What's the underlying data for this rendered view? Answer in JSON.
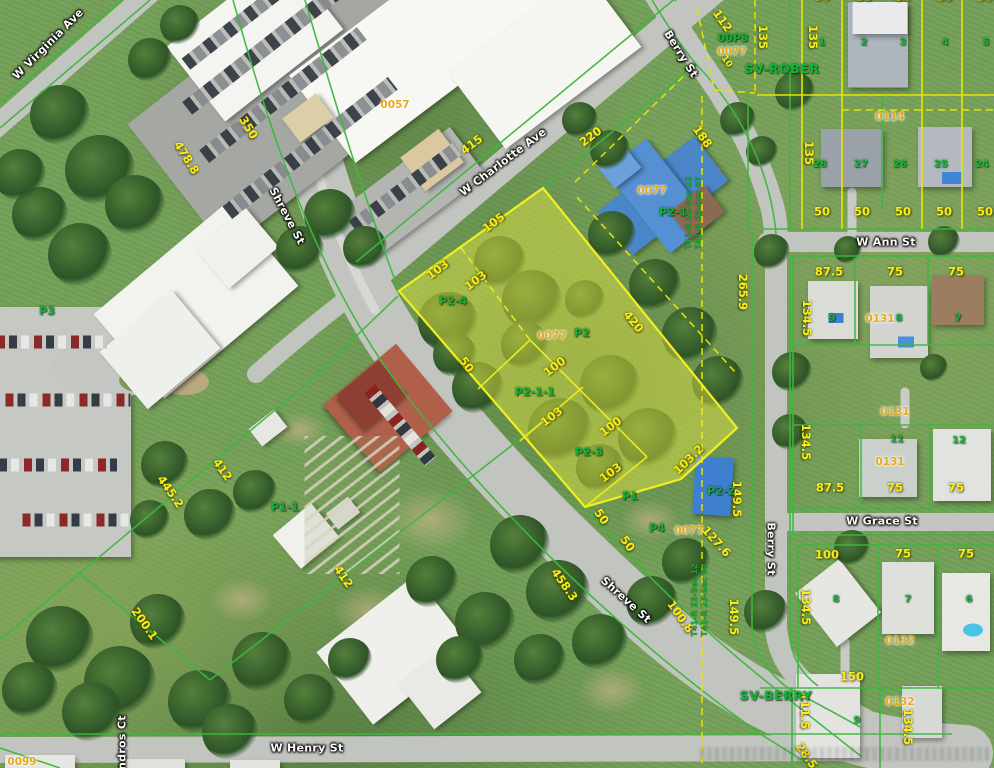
{
  "map": {
    "description": "Aerial parcel map with highlighted subject parcels",
    "colors": {
      "highlight_fill": "rgba(247,242,66,0.42)",
      "highlight_stroke": "#f2ef20",
      "parcel_line_green": "#3db83f",
      "parcel_line_yellow": "#e6e600",
      "dimension_text": "#f8ef14",
      "parcel_id_text": "#12b03a",
      "plat_code_text": "#e8a81e",
      "street_text": "#fbfbf9"
    }
  },
  "labels": {
    "streets": [
      {
        "t": "W Virginia Ave",
        "x": 48,
        "y": 44,
        "r": -45
      },
      {
        "t": "Shreve St",
        "x": 287,
        "y": 216,
        "r": 62
      },
      {
        "t": "W Charlotte Ave",
        "x": 503,
        "y": 162,
        "r": -37
      },
      {
        "t": "Berry St",
        "x": 681,
        "y": 54,
        "r": 58
      },
      {
        "t": "W Ann St",
        "x": 886,
        "y": 242,
        "r": 0
      },
      {
        "t": "W Grace St",
        "x": 882,
        "y": 521,
        "r": 0
      },
      {
        "t": "Berry St",
        "x": 771,
        "y": 549,
        "r": 90
      },
      {
        "t": "Shreve St",
        "x": 626,
        "y": 600,
        "r": 42
      },
      {
        "t": "W Henry St",
        "x": 307,
        "y": 748,
        "r": 0
      },
      {
        "t": "Andros Ct",
        "x": 122,
        "y": 747,
        "r": -90
      }
    ],
    "dimensions": [
      {
        "t": "350",
        "x": 248,
        "y": 128,
        "r": 58
      },
      {
        "t": "478.8",
        "x": 186,
        "y": 158,
        "r": 58
      },
      {
        "t": "415",
        "x": 472,
        "y": 145,
        "r": -37
      },
      {
        "t": "220",
        "x": 591,
        "y": 137,
        "r": -37
      },
      {
        "t": "112",
        "x": 722,
        "y": 21,
        "r": 55
      },
      {
        "t": "10",
        "x": 726,
        "y": 62,
        "r": 55,
        "s": 9
      },
      {
        "t": "135",
        "x": 762,
        "y": 37,
        "r": 90
      },
      {
        "t": "135",
        "x": 812,
        "y": 37,
        "r": 90
      },
      {
        "t": "135",
        "x": 808,
        "y": 153,
        "r": 90
      },
      {
        "t": "188",
        "x": 702,
        "y": 137,
        "r": 55
      },
      {
        "t": "50",
        "x": 822,
        "y": -3,
        "r": 0
      },
      {
        "t": "50",
        "x": 864,
        "y": -3,
        "r": 0
      },
      {
        "t": "50",
        "x": 903,
        "y": -3,
        "r": 0
      },
      {
        "t": "50",
        "x": 945,
        "y": -3,
        "r": 0
      },
      {
        "t": "50",
        "x": 985,
        "y": -3,
        "r": 0
      },
      {
        "t": "50",
        "x": 822,
        "y": 212,
        "r": 0
      },
      {
        "t": "50",
        "x": 862,
        "y": 212,
        "r": 0
      },
      {
        "t": "50",
        "x": 903,
        "y": 212,
        "r": 0
      },
      {
        "t": "50",
        "x": 944,
        "y": 212,
        "r": 0
      },
      {
        "t": "50",
        "x": 985,
        "y": 212,
        "r": 0
      },
      {
        "t": "105",
        "x": 494,
        "y": 223,
        "r": -37
      },
      {
        "t": "103",
        "x": 438,
        "y": 270,
        "r": -37
      },
      {
        "t": "103",
        "x": 476,
        "y": 281,
        "r": -37
      },
      {
        "t": "420",
        "x": 633,
        "y": 322,
        "r": 51
      },
      {
        "t": "265.9",
        "x": 742,
        "y": 292,
        "r": 90
      },
      {
        "t": "50",
        "x": 466,
        "y": 365,
        "r": 55
      },
      {
        "t": "100",
        "x": 555,
        "y": 367,
        "r": -37
      },
      {
        "t": "103",
        "x": 552,
        "y": 417,
        "r": -37
      },
      {
        "t": "100",
        "x": 611,
        "y": 427,
        "r": -37
      },
      {
        "t": "103",
        "x": 611,
        "y": 473,
        "r": -37
      },
      {
        "t": "103.2",
        "x": 689,
        "y": 460,
        "r": -44
      },
      {
        "t": "50",
        "x": 601,
        "y": 517,
        "r": 55
      },
      {
        "t": "50",
        "x": 627,
        "y": 544,
        "r": 55
      },
      {
        "t": "127.6",
        "x": 716,
        "y": 542,
        "r": 48
      },
      {
        "t": "149.5",
        "x": 736,
        "y": 499,
        "r": 90
      },
      {
        "t": "87.5",
        "x": 829,
        "y": 272,
        "r": 0
      },
      {
        "t": "75",
        "x": 895,
        "y": 272,
        "r": 0
      },
      {
        "t": "75",
        "x": 956,
        "y": 272,
        "r": 0
      },
      {
        "t": "134.5",
        "x": 806,
        "y": 318,
        "r": 90
      },
      {
        "t": "134.5",
        "x": 805,
        "y": 442,
        "r": 90
      },
      {
        "t": "87.5",
        "x": 830,
        "y": 488,
        "r": 0
      },
      {
        "t": "75",
        "x": 895,
        "y": 488,
        "r": 0
      },
      {
        "t": "75",
        "x": 956,
        "y": 488,
        "r": 0
      },
      {
        "t": "100",
        "x": 827,
        "y": 555,
        "r": 0
      },
      {
        "t": "75",
        "x": 903,
        "y": 554,
        "r": 0
      },
      {
        "t": "75",
        "x": 966,
        "y": 554,
        "r": 0
      },
      {
        "t": "134.5",
        "x": 805,
        "y": 607,
        "r": 90
      },
      {
        "t": "149.5",
        "x": 733,
        "y": 617,
        "r": 90
      },
      {
        "t": "150",
        "x": 852,
        "y": 677,
        "r": 0
      },
      {
        "t": "111.5",
        "x": 804,
        "y": 711,
        "r": 90
      },
      {
        "t": "134.5",
        "x": 907,
        "y": 727,
        "r": 90
      },
      {
        "t": "28.5",
        "x": 806,
        "y": 756,
        "r": 55
      },
      {
        "t": "458.3",
        "x": 564,
        "y": 585,
        "r": 55
      },
      {
        "t": "100.8",
        "x": 680,
        "y": 617,
        "r": 55
      },
      {
        "t": "412",
        "x": 222,
        "y": 470,
        "r": 55
      },
      {
        "t": "445.2",
        "x": 170,
        "y": 492,
        "r": 55
      },
      {
        "t": "412",
        "x": 343,
        "y": 577,
        "r": 55
      },
      {
        "t": "200.1",
        "x": 144,
        "y": 624,
        "r": 55
      }
    ],
    "plat_codes": [
      {
        "t": "0057",
        "x": 395,
        "y": 105
      },
      {
        "t": "0077",
        "x": 732,
        "y": 52
      },
      {
        "t": "0077",
        "x": 652,
        "y": 191
      },
      {
        "t": "0077",
        "x": 552,
        "y": 336
      },
      {
        "t": "0077",
        "x": 689,
        "y": 531
      },
      {
        "t": "0114",
        "x": 890,
        "y": 117
      },
      {
        "t": "0131",
        "x": 880,
        "y": 319
      },
      {
        "t": "0131",
        "x": 895,
        "y": 412
      },
      {
        "t": "0131",
        "x": 890,
        "y": 462
      },
      {
        "t": "0132",
        "x": 900,
        "y": 641
      },
      {
        "t": "0132",
        "x": 900,
        "y": 702
      },
      {
        "t": "0099",
        "x": 22,
        "y": 762
      }
    ],
    "parcel_ids": [
      {
        "t": "P3",
        "x": 47,
        "y": 311
      },
      {
        "t": "P2-4",
        "x": 453,
        "y": 301
      },
      {
        "t": "P2",
        "x": 582,
        "y": 333
      },
      {
        "t": "P2-1-1",
        "x": 535,
        "y": 392
      },
      {
        "t": "P2-3",
        "x": 589,
        "y": 452
      },
      {
        "t": "P1",
        "x": 630,
        "y": 496
      },
      {
        "t": "P4",
        "x": 657,
        "y": 528
      },
      {
        "t": "P2-1",
        "x": 673,
        "y": 212
      },
      {
        "t": "P2-2",
        "x": 721,
        "y": 491
      },
      {
        "t": "P1-1",
        "x": 285,
        "y": 507
      },
      {
        "t": "00P3",
        "x": 733,
        "y": 38
      }
    ],
    "subdivisions": [
      {
        "t": "SV-ROBER",
        "x": 782,
        "y": 69
      },
      {
        "t": "SV-BERRY",
        "x": 776,
        "y": 696
      }
    ],
    "lot_numbers": [
      {
        "t": "1",
        "x": 822,
        "y": 43
      },
      {
        "t": "2",
        "x": 864,
        "y": 43
      },
      {
        "t": "3",
        "x": 903,
        "y": 43
      },
      {
        "t": "4",
        "x": 945,
        "y": 43
      },
      {
        "t": "5",
        "x": 986,
        "y": 43
      },
      {
        "t": "28",
        "x": 820,
        "y": 165
      },
      {
        "t": "27",
        "x": 861,
        "y": 165
      },
      {
        "t": "26",
        "x": 900,
        "y": 165
      },
      {
        "t": "25",
        "x": 941,
        "y": 165
      },
      {
        "t": "24",
        "x": 982,
        "y": 165
      },
      {
        "t": "9",
        "x": 832,
        "y": 319
      },
      {
        "t": "8",
        "x": 899,
        "y": 319
      },
      {
        "t": "7",
        "x": 958,
        "y": 319
      },
      {
        "t": "11",
        "x": 897,
        "y": 440
      },
      {
        "t": "12",
        "x": 959,
        "y": 441
      },
      {
        "t": "8",
        "x": 836,
        "y": 600
      },
      {
        "t": "7",
        "x": 908,
        "y": 600
      },
      {
        "t": "6",
        "x": 969,
        "y": 600
      },
      {
        "t": "9",
        "x": 857,
        "y": 721
      }
    ],
    "section_labels": [
      {
        "t": "T41-R 22-Sec 12",
        "x": 689,
        "y": 213,
        "r": -90
      },
      {
        "t": "T41-R 23-Sec 07",
        "x": 699,
        "y": 213,
        "r": -90
      },
      {
        "t": "T41-R 22-Sec 12",
        "x": 695,
        "y": 600,
        "r": -90
      },
      {
        "t": "T41-R 23-Sec 07",
        "x": 705,
        "y": 600,
        "r": -90
      }
    ]
  }
}
